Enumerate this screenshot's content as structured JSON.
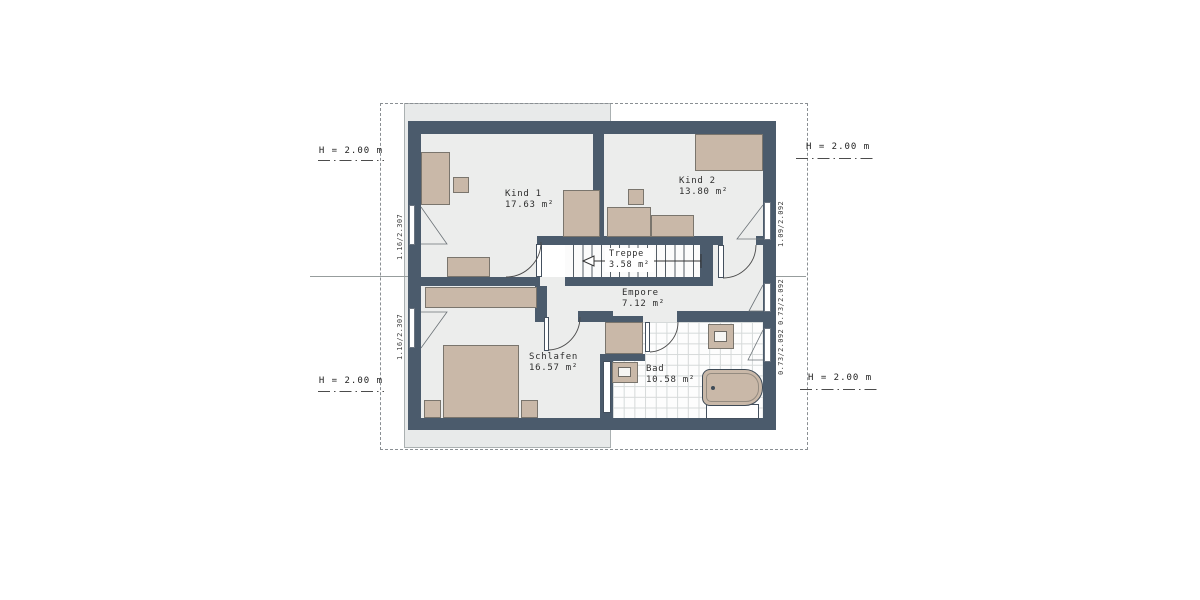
{
  "plan": {
    "rooms": {
      "kind1": {
        "name": "Kind 1",
        "area": "17.63 m²"
      },
      "kind2": {
        "name": "Kind 2",
        "area": "13.80 m²"
      },
      "treppe": {
        "name": "Treppe",
        "area": "3.58 m²"
      },
      "empore": {
        "name": "Empore",
        "area": "7.12 m²"
      },
      "schlafen": {
        "name": "Schlafen",
        "area": "16.57 m²"
      },
      "bad": {
        "name": "Bad",
        "area": "10.58 m²"
      }
    },
    "height_labels": {
      "left_top": "H = 2.00 m",
      "left_bottom": "H = 2.00 m",
      "right_top": "H = 2.00 m",
      "right_bottom": "H = 2.00 m"
    },
    "window_dimensions": {
      "left_upper": "1.16/2.307",
      "left_lower": "1.16/2.307",
      "right_upper": "1.09/2.092",
      "right_middle": "0.73/2.092",
      "right_lower": "0.73/2.092"
    },
    "colors": {
      "wall": "#4b5b6c",
      "floor": "#ecedec",
      "furniture": "#c9b8a8",
      "band": "#e8eaea"
    }
  }
}
